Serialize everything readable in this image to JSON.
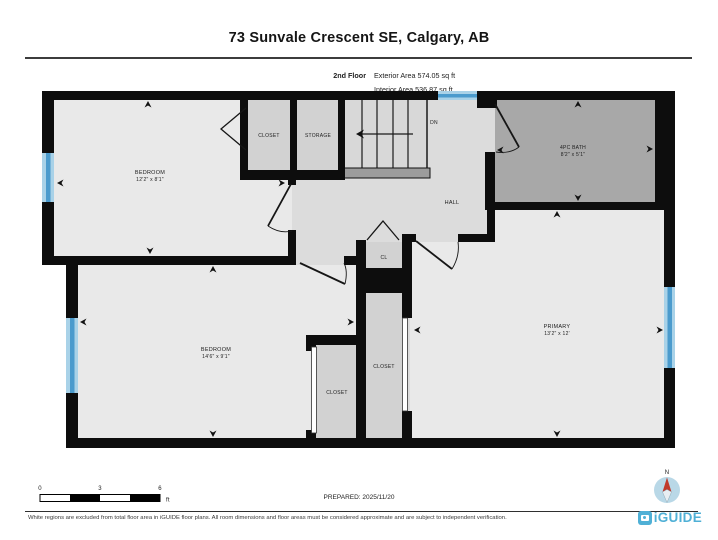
{
  "header": {
    "title": "73 Sunvale Crescent SE, Calgary, AB",
    "floor_label": "2nd Floor",
    "exterior_area": "Exterior Area 574.05 sq ft",
    "interior_area": "Interior Area 536.87 sq ft"
  },
  "plan": {
    "bedroom_top": {
      "name": "BEDROOM",
      "dims": "12'2\" x 8'1\""
    },
    "bedroom_bottom": {
      "name": "BEDROOM",
      "dims": "14'6\" x 9'1\""
    },
    "primary": {
      "name": "PRIMARY",
      "dims": "13'2\" x 12'"
    },
    "bath": {
      "name": "4PC BATH",
      "dims": "8'2\" x 5'1\""
    },
    "closet_top": "CLOSET",
    "storage": "STORAGE",
    "hall": "HALL",
    "cl": "CL",
    "closet_primary": "CLOSET",
    "closet_bedroom": "CLOSET",
    "stair_direction": "DN"
  },
  "footer": {
    "scale_ticks": [
      "0",
      "3",
      "6"
    ],
    "scale_unit": "ft",
    "prepared": "PREPARED: 2025/11/20",
    "compass": "N",
    "disclaimer": "White regions are excluded from total floor area in iGUIDE floor plans. All room dimensions and floor areas must be considered approximate and are subject to independent verification.",
    "brand": "iGUIDE"
  },
  "colors": {
    "wall": "#0d0d0d",
    "floor_room": "#e9e9e9",
    "floor_hall": "#dcdcdc",
    "floor_closet": "#d2d2d2",
    "floor_bath": "#a8a8a8",
    "window_light": "#a9d2e8",
    "window_dark": "#4b9bcd",
    "brand_blue": "#4fb0d6",
    "compass_fill": "#b9d8e7",
    "needle_red": "#c0392b"
  }
}
